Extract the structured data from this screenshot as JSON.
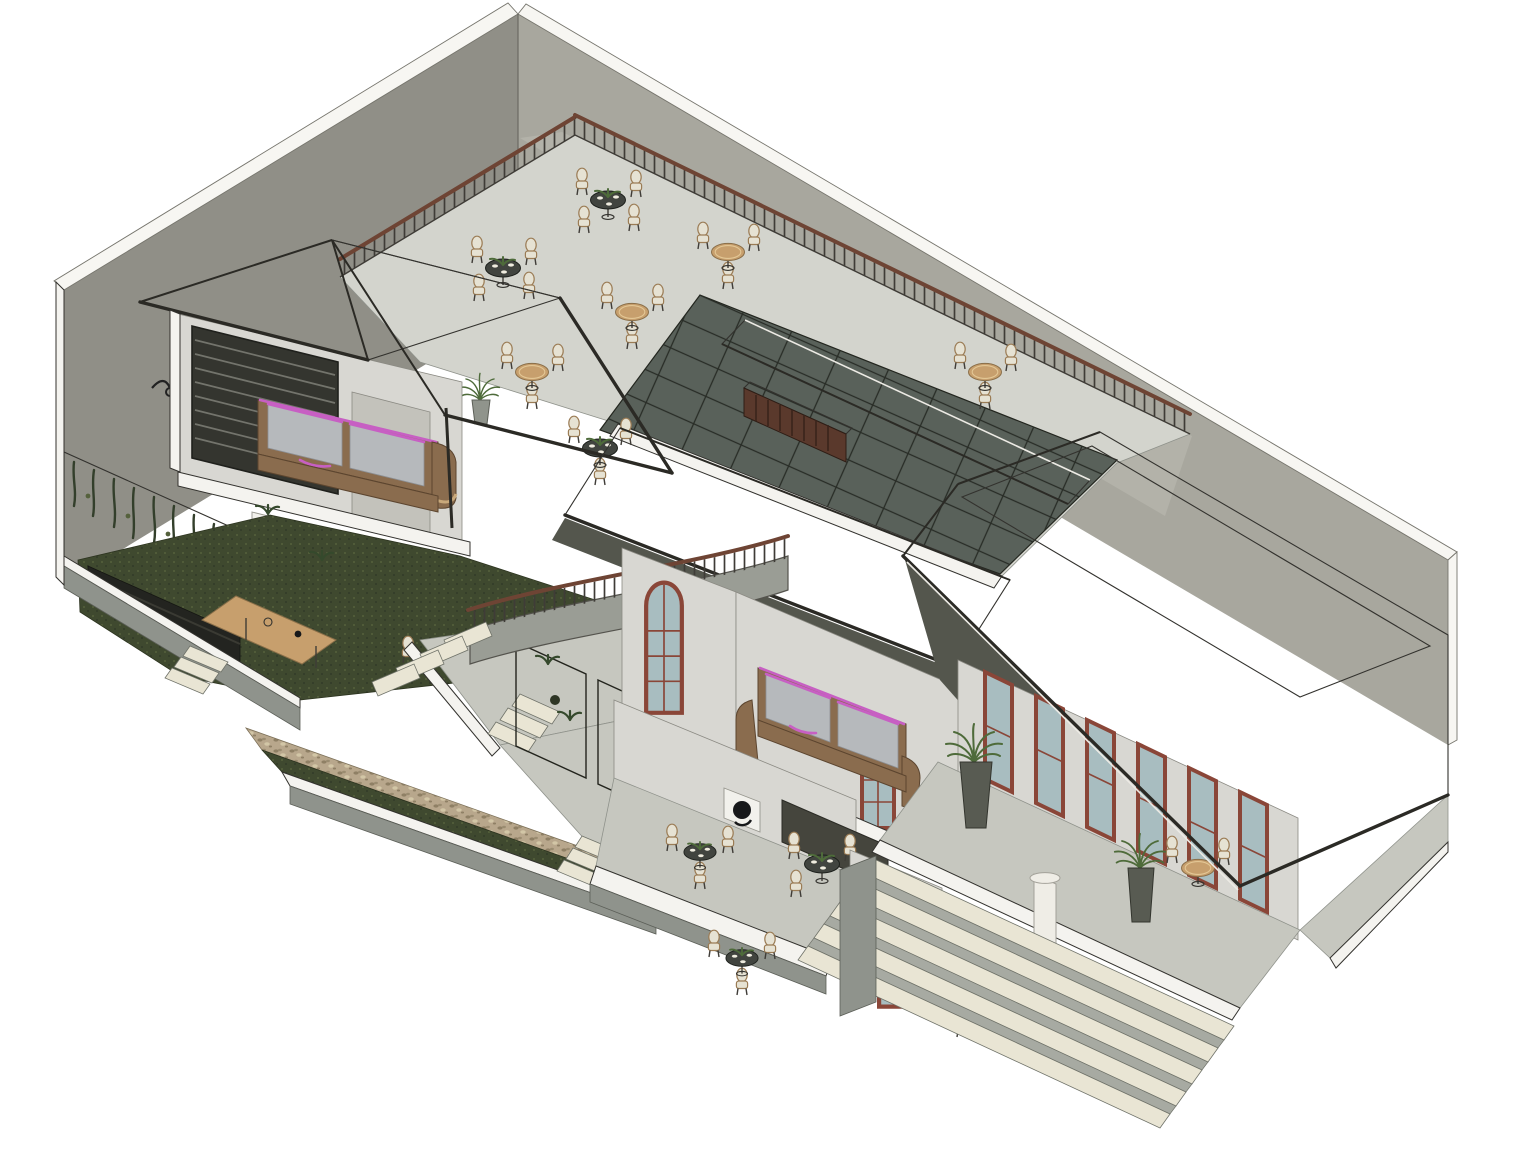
{
  "scene": {
    "type": "isometric-architectural-cutaway-render",
    "description": "Isometric 3D sectional rendering of a two-storey cafe building: rooftop dining terrace with railing and round tables, dark glass skylight, two tiled gable roofs and a large hipped roof, cutaway lounge rooms with brown sofas trimmed in magenta, interior courtyard garden with lawn and hanging vines, curved staircase, gravel drainage strip with plant trellis screens, arched red-brown framed windows, and an entrance porch with white column and wide steps",
    "areas": [
      {
        "name": "rooftop-terrace",
        "features": [
          "round glass dining tables with place settings",
          "round wooden tables",
          "bentwood chairs with cream cushions",
          "metal railing with wood handrail",
          "dark slatted console",
          "potted plant"
        ]
      },
      {
        "name": "skylight",
        "features": [
          "dark glass panels",
          "black mullion grid",
          "tiled ridge strip"
        ]
      },
      {
        "name": "left-pavilion",
        "features": [
          "gabled tile roof",
          "cutaway lounge",
          "sofa with magenta trim",
          "louvered window",
          "wall lamp",
          "white planter"
        ]
      },
      {
        "name": "courtyard-garden",
        "features": [
          "dark lawn",
          "hanging vines",
          "black banquette bench",
          "wooden coffee table",
          "white chair",
          "potted plants",
          "perimeter slab steps"
        ]
      },
      {
        "name": "central-hall",
        "features": [
          "curved staircase",
          "arched window",
          "plant trellis screens",
          "gravel strip with grass",
          "ground-floor dining tables",
          "round wall art",
          "service opening",
          "sofa with magenta trim",
          "balcony with potted palm"
        ]
      },
      {
        "name": "entrance-porch",
        "features": [
          "hipped tile roof with flat ridge",
          "arched french doors",
          "red-brown window frames",
          "white column",
          "round wooden tables",
          "potted palms",
          "wide entry steps"
        ]
      }
    ],
    "counts": {
      "terrace_tables": 7,
      "ground_floor_tables": 4,
      "porch_tables": 2,
      "sofas": 2,
      "curved_staircases": 1,
      "step_flights": 6,
      "trellis_panels": 3
    }
  },
  "colors": {
    "background": "#ffffff",
    "wall_left": "#908f87",
    "wall_right": "#a8a79e",
    "wall_cap": "#f7f6f2",
    "lower_wall": "#b3b2a9",
    "interior_wall": "#d8d7d2",
    "cut_white": "#f4f3ef",
    "edge_dark": "#33322e",
    "terrace_floor": "#d3d4cd",
    "ground_floor": "#c6c7bf",
    "slab_side": "#8f938c",
    "step_tread": "#e9e5d4",
    "step_riser": "#a7aaa2",
    "glass_dark": "#59615a",
    "glass_grid": "#282c26",
    "roof_light": "#c2b296",
    "roof_mid": "#a5947c",
    "roof_dark": "#837662",
    "roof_shadow": "#6e6455",
    "fascia": "#2b2a25",
    "rail_wood": "#6e4434",
    "rail_metal": "#3f3c37",
    "grass": "#3f492f",
    "vine": "#333f2b",
    "plant": "#4e6b3a",
    "pot": "#90948c",
    "wood": "#c79f6d",
    "table_dark": "#41443f",
    "chair_cream": "#e6e2d3",
    "chair_frame": "#9b7c55",
    "sofa_brown": "#8a6c4e",
    "sofa_cushion": "#b6b9bc",
    "sofa_trim": "#c75fc3",
    "window_frame": "#8a4638",
    "window_glass": "#a8bdc0",
    "column": "#efede6",
    "gravel": "#b8a78c",
    "console": "#5a392c",
    "bench": "#232420",
    "shadow": "#54564d"
  }
}
